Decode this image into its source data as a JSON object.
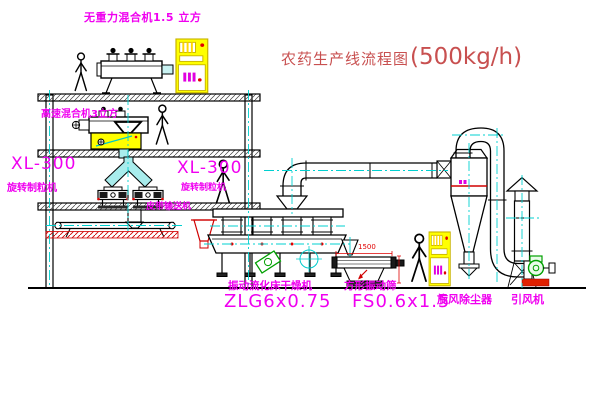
{
  "title": {
    "text": "农药生产线流程图",
    "capacity": "(500kg/h)"
  },
  "equipment": {
    "gravity_mixer": {
      "label": "无重力混合机1.5 立方"
    },
    "high_speed_mixer": {
      "label": "高速混合机3立方"
    },
    "granulator_left": {
      "model": "XL-300",
      "name": "旋转制粒机"
    },
    "granulator_mid": {
      "model": "XL-300",
      "name": "旋转制粒机"
    },
    "belt_conveyor": {
      "name": "皮带输送机"
    },
    "fluid_bed_dryer": {
      "name": "振动流化床干燥机",
      "model": "ZLG6x0.75"
    },
    "square_screen": {
      "name": "方形振动筛",
      "model": "FS0.6x1.5",
      "dimension": "1500"
    },
    "cyclone": {
      "name": "旋风除尘器"
    },
    "draft_fan": {
      "name": "引风机"
    }
  },
  "colors": {
    "label_magenta": "#f000f0",
    "title_red": "#c85050",
    "dimension_red": "#e00000",
    "line_black": "#000000",
    "centerline_cyan": "#00d0d0",
    "cabinet_yellow": "#ffff00",
    "fan_green": "#00a000",
    "pipe_cyan_fill": "#a8ecec"
  }
}
